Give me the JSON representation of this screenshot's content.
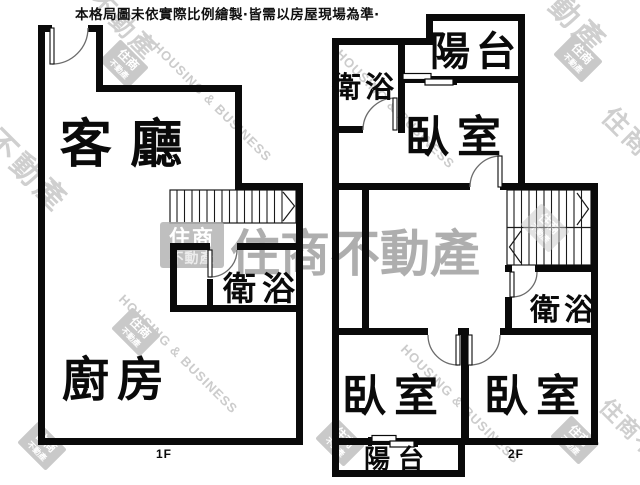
{
  "disclaimer": "本格局圖未依實際比例繪製‧皆需以房屋現場為準‧",
  "floor1": {
    "label": "1F",
    "rooms": {
      "living": "客 廳",
      "bath": "衛浴",
      "kitchen": "廚房"
    }
  },
  "floor2": {
    "label": "2F",
    "rooms": {
      "balcony_top": "陽台",
      "bath_top": "衛浴",
      "bedroom_top": "臥室",
      "bath_mid": "衛浴",
      "bedroom_left": "臥室",
      "bedroom_right": "臥室",
      "balcony_bottom": "陽台"
    }
  },
  "watermark": {
    "brand": "住商不動產",
    "brand_en": "HOUSING & BUSINESS",
    "logo_top": "住商",
    "logo_bottom": "不動產",
    "fragment": "不動產",
    "colors": {
      "center_text": "#9b9b9b",
      "diagonal_text": "#cfcfcf",
      "logo_box": "#b2b2b2"
    }
  },
  "colors": {
    "wall": "#0a0a0a",
    "background": "#ffffff"
  }
}
